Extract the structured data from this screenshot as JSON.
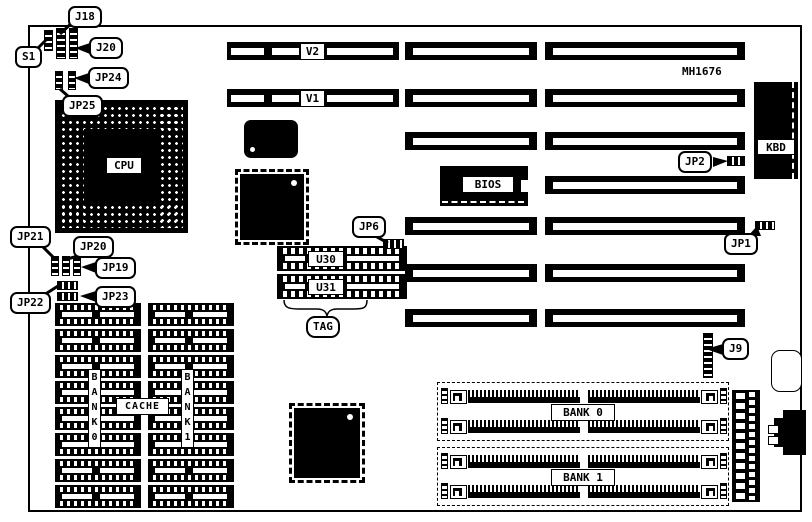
{
  "board": {
    "model": "MH1676"
  },
  "callouts": {
    "s1": "S1",
    "j18": "J18",
    "j20": "J20",
    "jp24": "JP24",
    "jp25": "JP25",
    "jp21": "JP21",
    "jp20": "JP20",
    "jp19": "JP19",
    "jp22": "JP22",
    "jp23": "JP23",
    "jp6": "JP6",
    "jp2": "JP2",
    "jp1": "JP1",
    "j9": "J9",
    "tag": "TAG"
  },
  "chips": {
    "cpu": "CPU",
    "bios": "BIOS",
    "kbd": "KBD",
    "u30": "U30",
    "u31": "U31"
  },
  "slots": {
    "v1": "V1",
    "v2": "V2"
  },
  "cache": {
    "label": "CACHE",
    "bank0": "BANK0",
    "bank1": "BANK1"
  },
  "memory": {
    "bank0": "BANK 0",
    "bank1": "BANK 1"
  }
}
